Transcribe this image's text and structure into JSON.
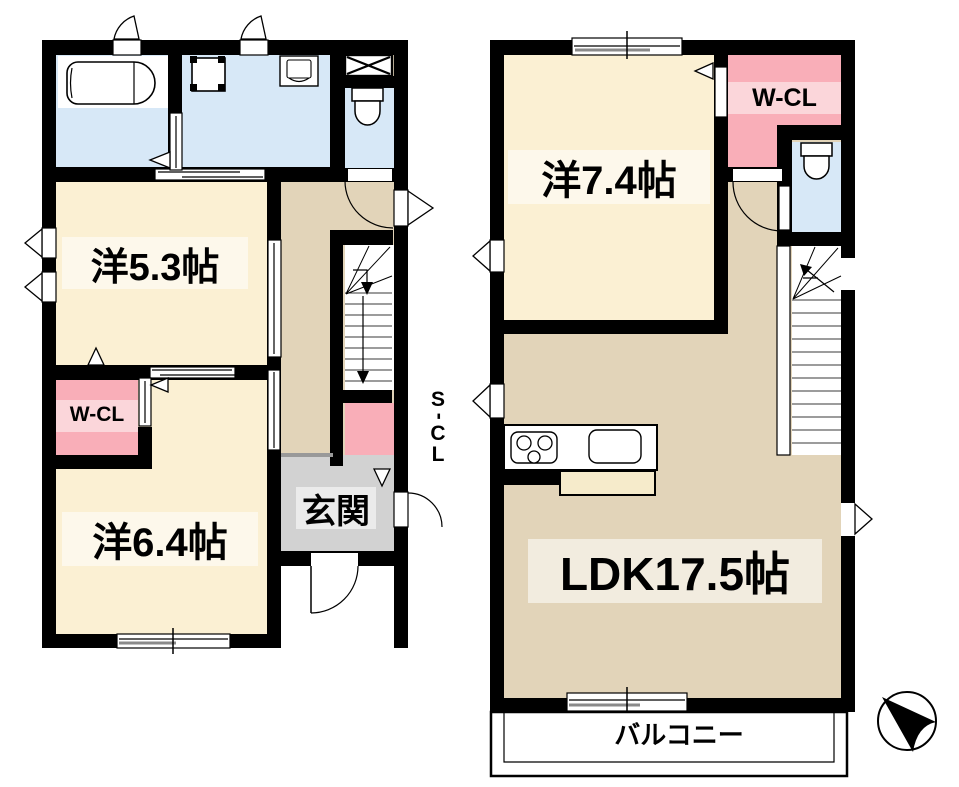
{
  "colors": {
    "wall": "#000000",
    "bedroom": "#FBF0D3",
    "hall": "#E2D4B9",
    "water": "#D7E8F7",
    "closet": "#F9AEB8",
    "closet_band": "#FBD6DA",
    "entrance": "#D2D2D2",
    "stairs": "#FFFFFF",
    "porch": "#FFFFFF",
    "balcony": "#FFFFFF",
    "counter_low": "#F6EBCB"
  },
  "floor1": {
    "labels": {
      "bedroom53": "洋5.3帖",
      "bedroom64": "洋6.4帖",
      "wcl": "W-CL",
      "entrance": "玄関",
      "scl": "S-CL",
      "scl_letters": [
        "S",
        "-",
        "C",
        "L"
      ]
    }
  },
  "floor2": {
    "labels": {
      "bedroom74": "洋7.4帖",
      "wcl": "W-CL",
      "ldk": "LDK17.5帖",
      "balcony": "バルコニー"
    }
  },
  "icons": {
    "north_arrow": "north-arrow-compass"
  }
}
